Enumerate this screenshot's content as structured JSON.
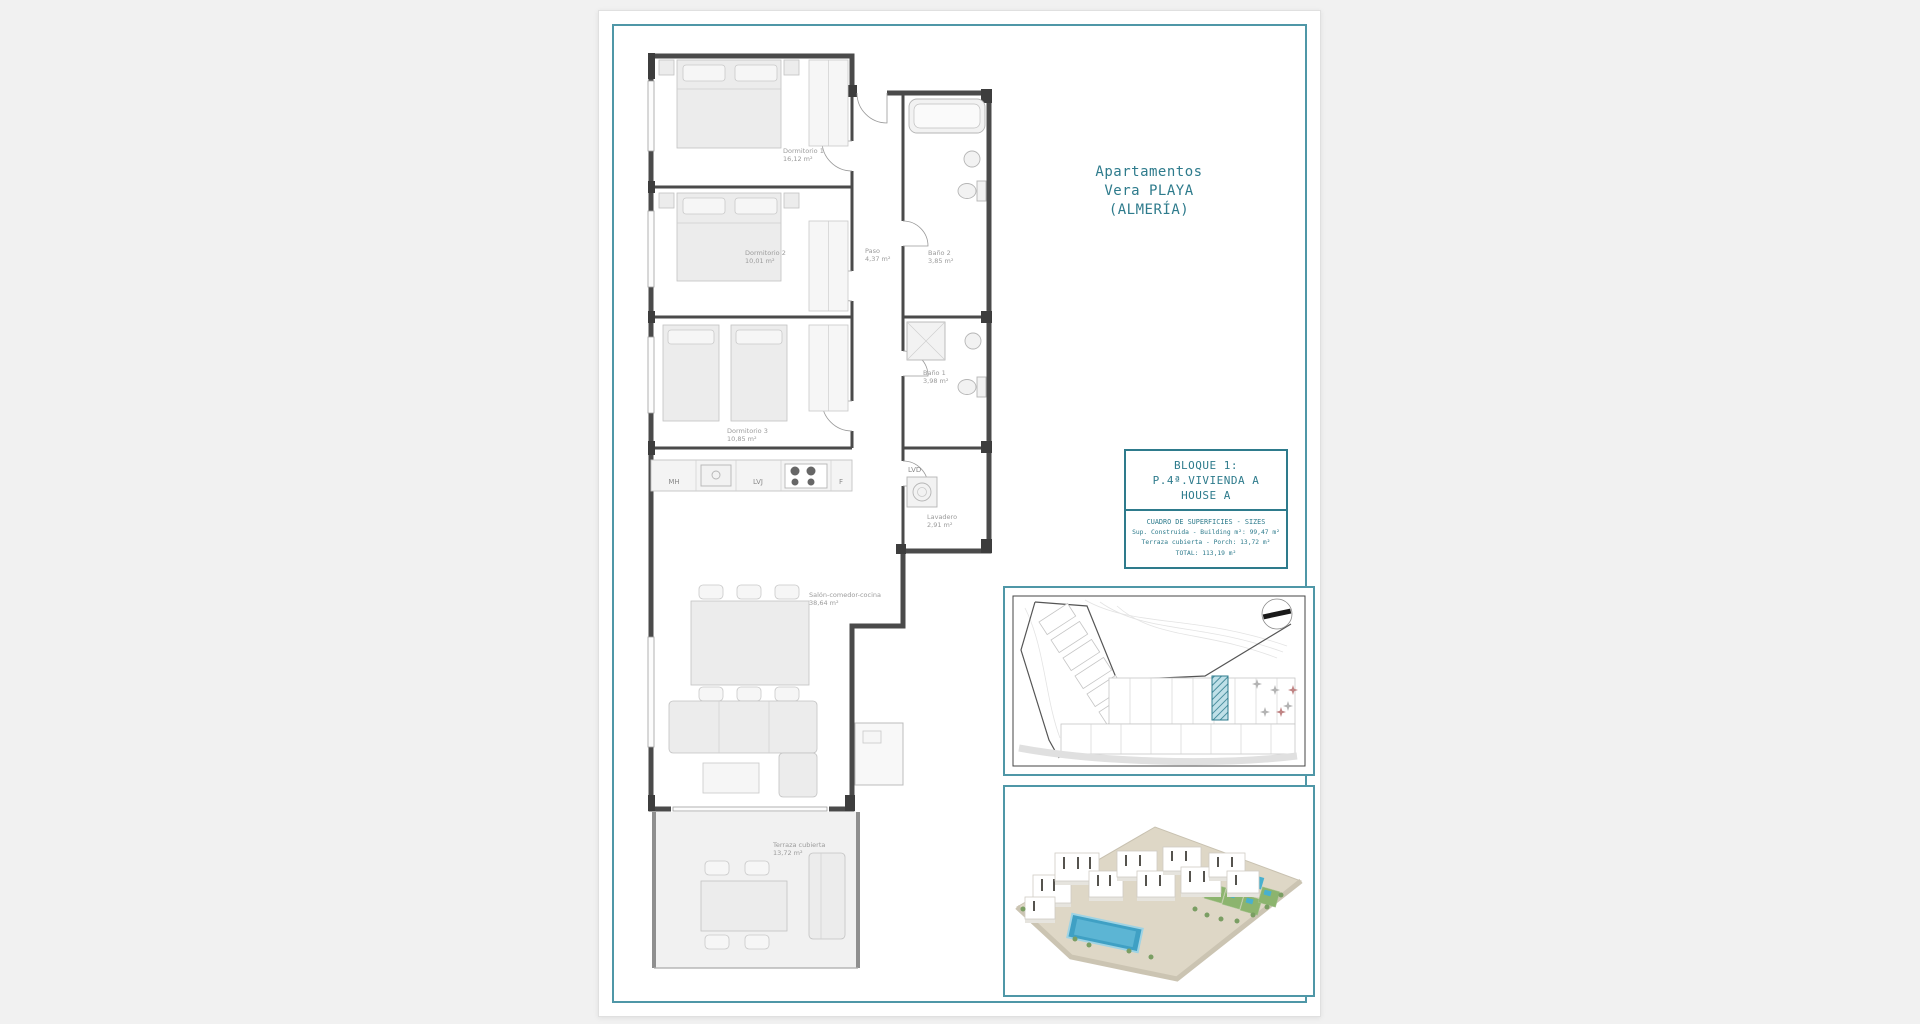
{
  "sheet": {
    "title_lines": [
      "Apartamentos",
      "Vera PLAYA",
      "(ALMERÍA)"
    ]
  },
  "info_box": {
    "block_lines": [
      "BLOQUE 1:",
      "P.4ª.VIVIENDA A",
      "HOUSE A"
    ],
    "sizes_title": "CUADRO DE SUPERFICIES - SIZES",
    "sizes_rows": [
      "Sup. Construida - Building m²: 99,47 m²",
      "Terraza cubierta - Porch: 13,72 m²",
      "TOTAL: 113,19 m²"
    ]
  },
  "floorplan": {
    "rooms": [
      {
        "name": "Dormitorio 1",
        "area": "16,12 m²"
      },
      {
        "name": "Dormitorio 2",
        "area": "10,01 m²"
      },
      {
        "name": "Dormitorio 3",
        "area": "10,85 m²"
      },
      {
        "name": "Paso",
        "area": "4,37 m²"
      },
      {
        "name": "Baño 2",
        "area": "3,85 m²"
      },
      {
        "name": "Baño 1",
        "area": "3,98 m²"
      },
      {
        "name": "Lavadero",
        "area": "2,91 m²"
      },
      {
        "name": "Salón-comedor-cocina",
        "area": "38,64 m²"
      },
      {
        "name": "Terraza cubierta",
        "area": "13,72 m²"
      }
    ],
    "appliance_labels": [
      "MH",
      "LVJ",
      "F",
      "LVD"
    ]
  },
  "colors": {
    "accent_teal": "#2e7b8c",
    "frame_border": "#4f97a7",
    "wall_gray": "#4a4a4a",
    "pool_blue": "#49b0cf",
    "lawn_green": "#8cb46e",
    "ground_beige": "#ded7c6"
  }
}
